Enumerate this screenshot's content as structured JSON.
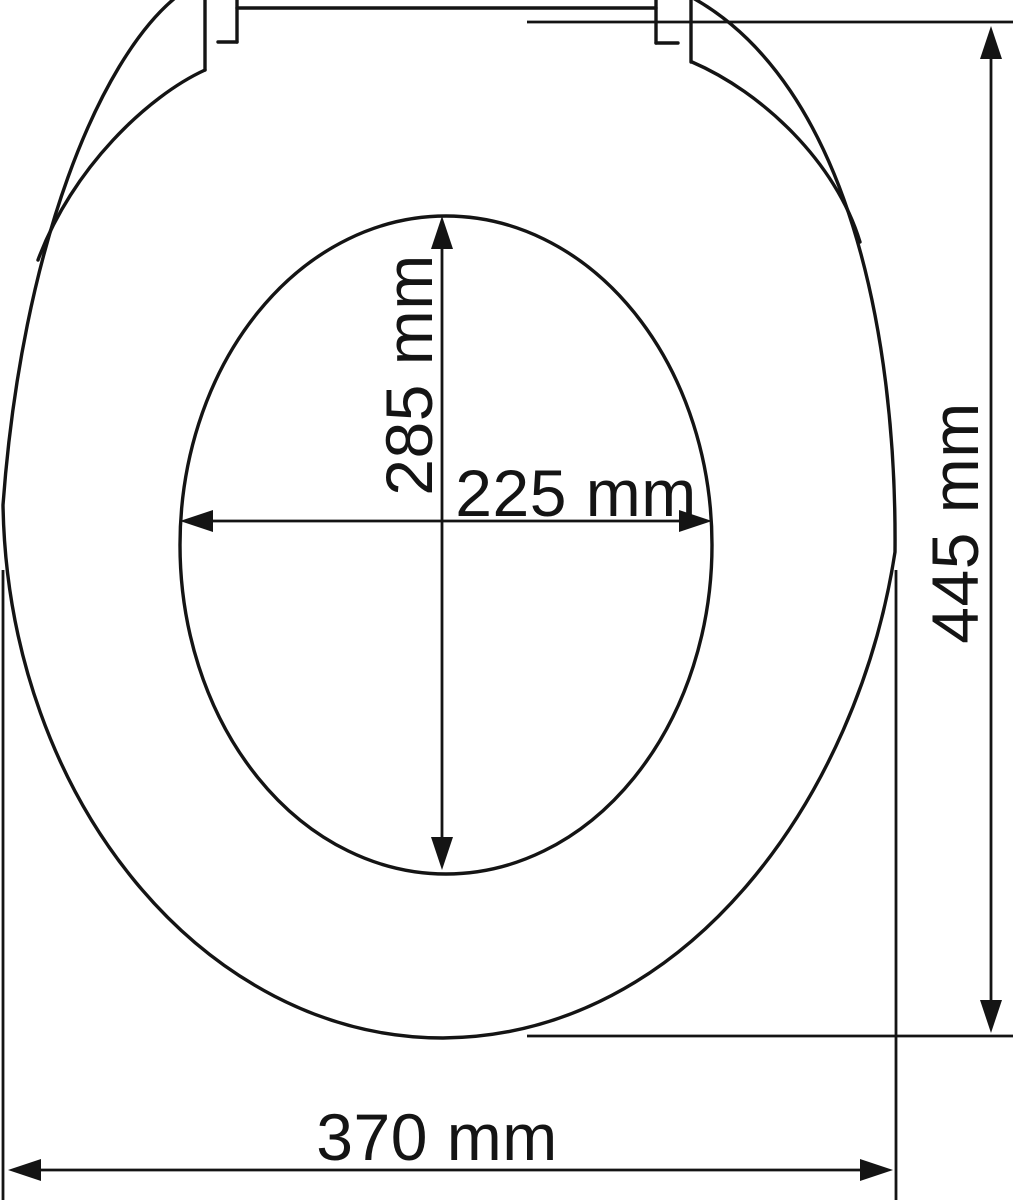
{
  "diagram": {
    "type": "technical-dimension-drawing",
    "subject": "toilet seat with lid, top view",
    "background_color": "#ffffff",
    "line_color": "#141414",
    "labels": {
      "inner_length": "285 mm",
      "inner_width": "225 mm",
      "overall_length": "445 mm",
      "overall_width": "370 mm"
    },
    "measurements": [
      {
        "name": "inner-opening-length",
        "value": 285,
        "unit": "mm",
        "orientation": "vertical"
      },
      {
        "name": "inner-opening-width",
        "value": 225,
        "unit": "mm",
        "orientation": "horizontal"
      },
      {
        "name": "overall-length",
        "value": 445,
        "unit": "mm",
        "orientation": "vertical"
      },
      {
        "name": "overall-width",
        "value": 370,
        "unit": "mm",
        "orientation": "horizontal"
      }
    ]
  }
}
